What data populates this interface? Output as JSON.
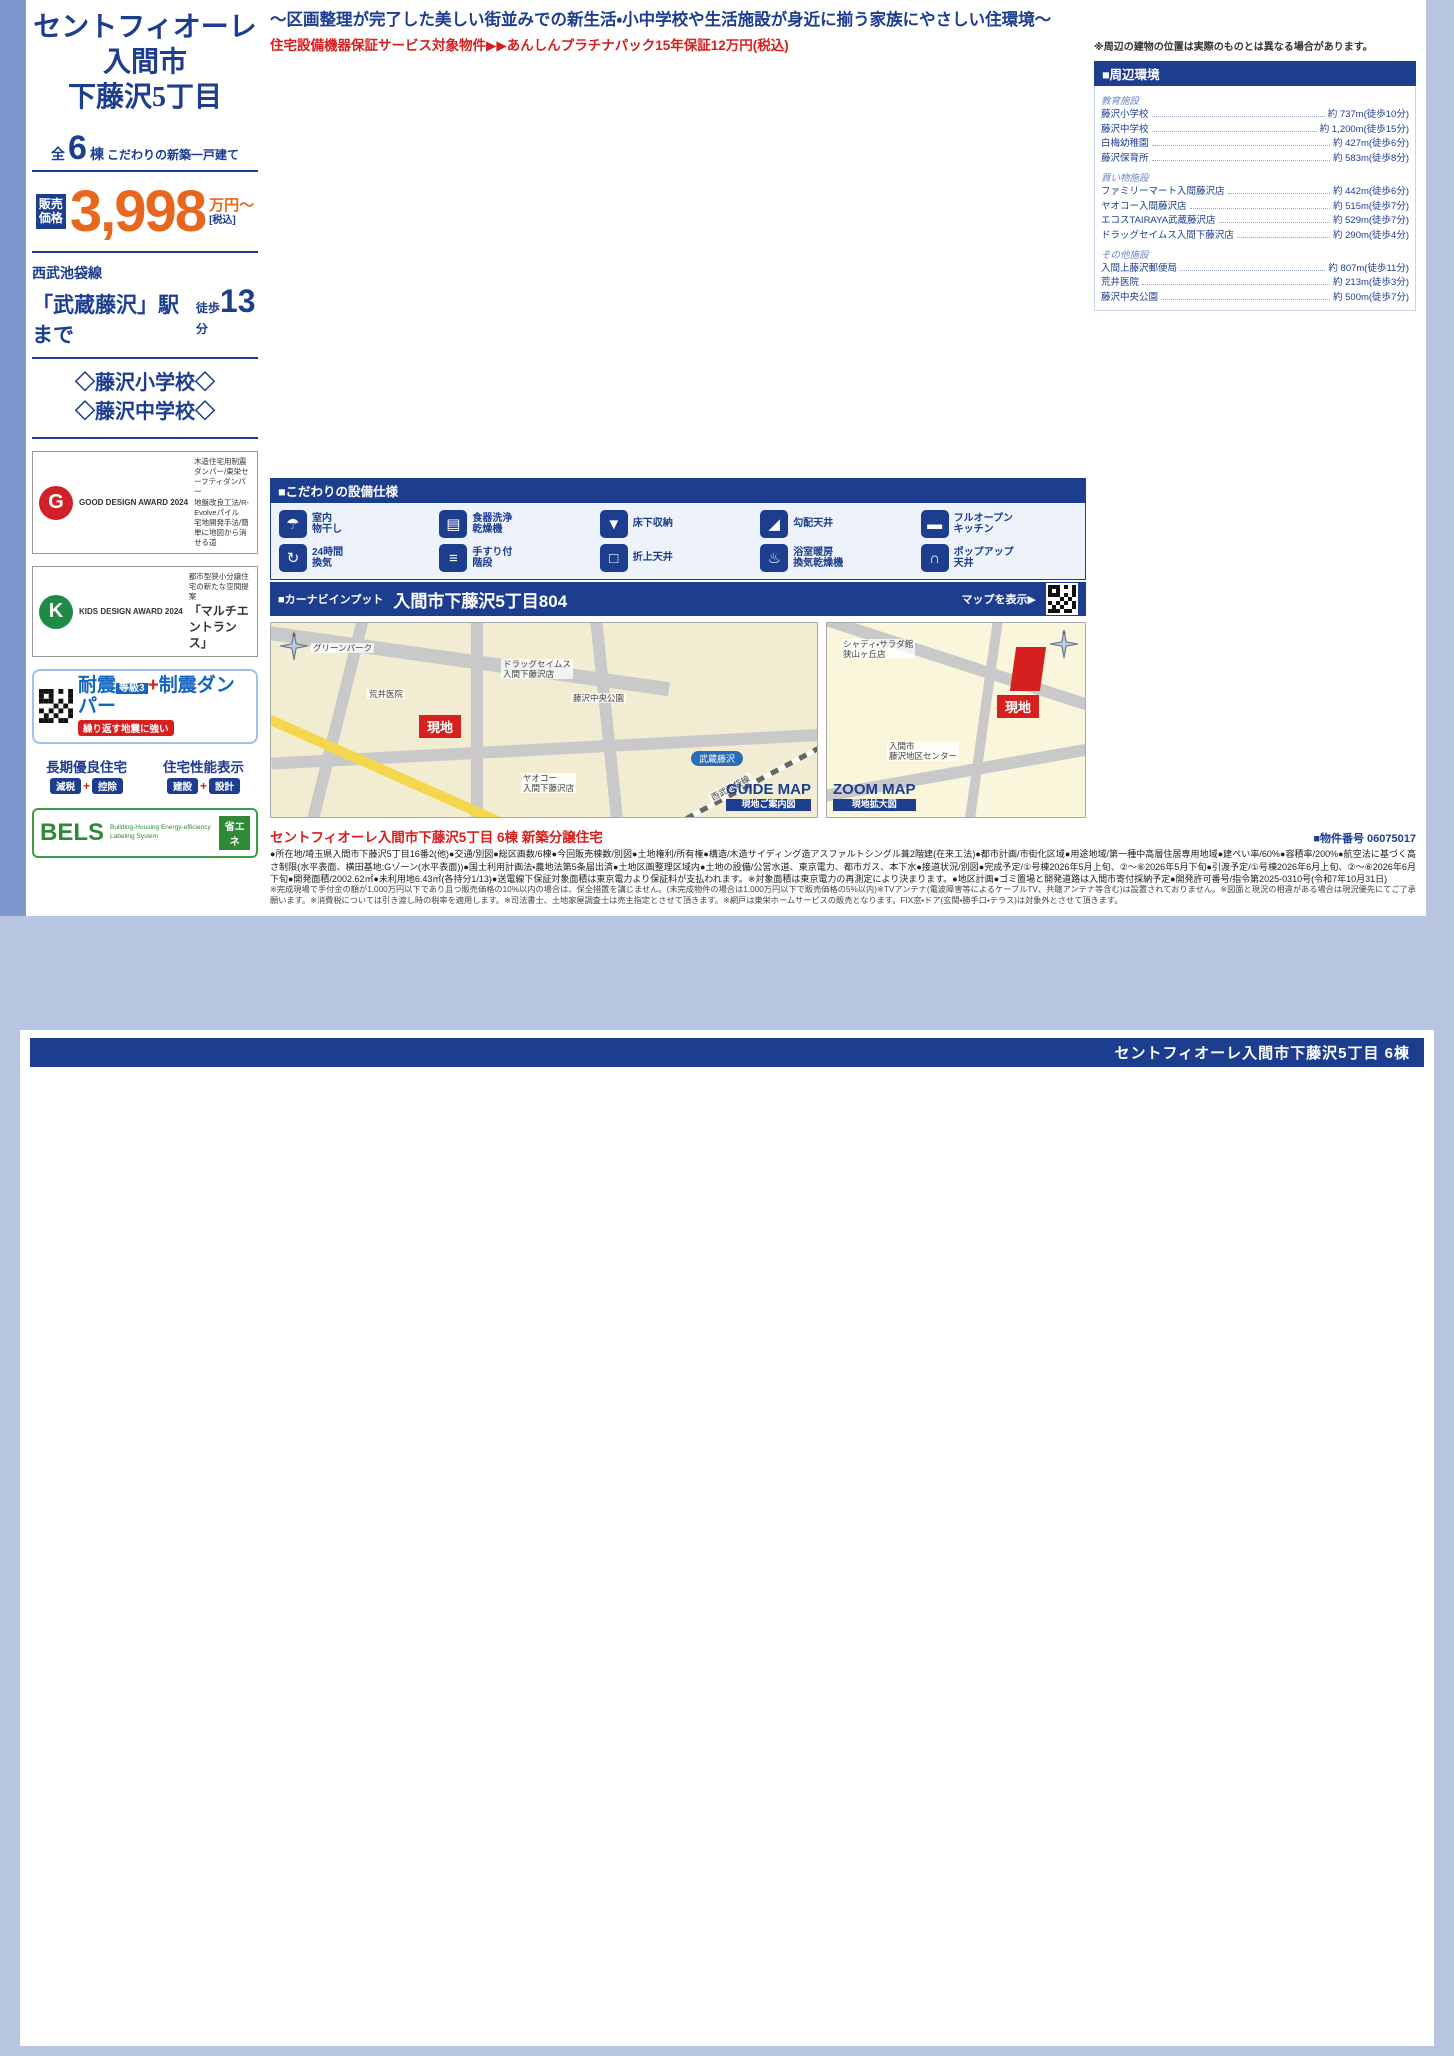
{
  "page1": {
    "catchphrase": "〜区画整理が完了した美しい街並みでの新生活・小中学校や生活施設が身近に揃う家族にやさしい住環境〜",
    "guarantee": "住宅設備機器保証サービス対象物件▶▶あんしんプラチナパック15年保証12万円(税込)",
    "sidebar": {
      "title1": "セントフィオーレ",
      "title2": "入間市",
      "title3": "下藤沢5丁目",
      "count_prefix": "全",
      "count": "6",
      "count_suffix": "棟",
      "count_note": "こだわりの新築一戸建て",
      "price_label": "販売価格",
      "price": "3,998",
      "price_unit": "万円〜",
      "price_tax": "[税込]",
      "rail_line": "西武池袋線",
      "station": "「武蔵藤沢」駅まで",
      "walk_label": "徒歩",
      "walk_min": "13",
      "walk_unit": "分",
      "school1": "◇藤沢小学校◇",
      "school2": "◇藤沢中学校◇",
      "good_design_award": "GOOD DESIGN AWARD 2024",
      "good_design_items": "木造住宅用制震ダンパー/東栄セーフティダンパー\n地盤改良工法/R-Evolveパイル\n宅地開発手法/簡単に地図から消せる道",
      "kids_design_award": "KIDS DESIGN AWARD 2024",
      "kids_design_line1": "都市型狭小分譲住宅の新たな空間提案",
      "kids_design_line2": "「マルチエントランス」",
      "taishin_a": "耐震",
      "taishin_grade": "等級3",
      "taishin_plus": "+",
      "taishin_b": "制震ダンパー",
      "taishin_note": "繰り返す地震に強い",
      "choki_title": "長期優良住宅",
      "choki_tag1": "減税",
      "choki_tag2": "控除",
      "seinou_title": "住宅性能表示",
      "seinou_tag1": "建設",
      "seinou_tag2": "設計",
      "bels_title": "BELS",
      "bels_sub": "Building-Housing Energy-efficiency Labeling System",
      "bels_tag": "省エネ"
    },
    "equipment_title": "■こだわりの設備仕様",
    "equipment": [
      {
        "icon": "☂",
        "name": "indoor-laundry-icon",
        "label": "室内\n物干し"
      },
      {
        "icon": "▤",
        "name": "dishwasher-icon",
        "label": "食器洗浄\n乾燥機"
      },
      {
        "icon": "▼",
        "name": "underfloor-storage-icon",
        "label": "床下収納"
      },
      {
        "icon": "◢",
        "name": "sloped-ceiling-icon",
        "label": "勾配天井"
      },
      {
        "icon": "▬",
        "name": "open-kitchen-icon",
        "label": "フルオープン\nキッチン"
      },
      {
        "icon": "↻",
        "name": "ventilation-icon",
        "label": "24時間\n換気"
      },
      {
        "icon": "≡",
        "name": "handrail-stairs-icon",
        "label": "手すり付\n階段"
      },
      {
        "icon": "□",
        "name": "coffered-ceiling-icon",
        "label": "折上天井"
      },
      {
        "icon": "♨",
        "name": "bath-dryer-icon",
        "label": "浴室暖房\n換気乾燥機"
      },
      {
        "icon": "∩",
        "name": "popup-ceiling-icon",
        "label": "ポップアップ\n天井"
      }
    ],
    "carnav_label": "■カーナビインプット",
    "carnav_address": "入間市下藤沢5丁目804",
    "carnav_map": "マップを表示▶",
    "guide_map": {
      "badge": "GUIDE MAP",
      "badge_sub": "現地ご案内図",
      "site": "現地",
      "station": "武蔵藤沢",
      "line": "西武池袋線",
      "poi1": "ドラッグセイムス\n入間下藤沢店",
      "poi2": "荒井医院",
      "poi3": "藤沢中央公園",
      "poi4": "ヤオコー\n入間下藤沢店",
      "poi5": "グリーンパーク"
    },
    "zoom_map": {
      "badge": "ZOOM MAP",
      "badge_sub": "現地拡大図",
      "site": "現地",
      "poi1": "シャディ・サラダ館\n狭山ヶ丘店",
      "poi2": "入間市\n藤沢地区センター"
    },
    "outline_title": "セントフィオーレ入間市下藤沢5丁目 6棟 新築分譲住宅",
    "outline_number": "■物件番号 06075017",
    "outline_body": "●所在地/埼玉県入間市下藤沢5丁目16番2(他)●交通/別図●総区画数/6棟●今回販売棟数/別図●土地権利/所有権●構造/木造サイディング造アスファルトシングル葺2階建(在来工法)●都市計画/市街化区域●用途地域/第一種中高層住居専用地域●建ぺい率/60%●容積率/200%●航空法に基づく高さ制限(水平表面、横田基地:Gゾーン(水平表面))●国土利用計画法・農地法第5条届出済●土地区画整理区域内●土地の設備/公営水道、東京電力、都市ガス、本下水●接道状況/別図●完成予定/①号棟2026年5月上旬、②〜⑥2026年5月下旬●引渡予定/①号棟2026年6月上旬、②〜⑥2026年6月下旬●開発面積/2002.62㎡●未利用地6.43㎡(各持分1/13)●送電線下保証対象面積は東京電力より保証料が支払われます。※対象面積は東京電力の再測定により決まります。●地区計画●ゴミ置場と開発道路は入間市寄付採納予定●開発許可番号/指令第2025-0310号(令和7年10月31日)",
    "disclaimer": "※完成現場で手付金の額が1,000万円以下であり且つ販売価格の10%以内の場合は、保全措置を講じません。(未完成物件の場合は1,000万円以下で販売価格の5%以内)※TVアンテナ(電波障害等によるケーブルTV、共聴アンテナ等含む)は設置されておりません。※図面と現況の相違がある場合は現況優先にてご了承願います。※消費税については引き渡し時の税率を適用します。※司法書士、土地家屋調査士は売主指定とさせて頂きます。※網戸は東栄ホームサービスの販売となります。FIX窓・ドア(玄関・勝手口・テラス)は対象外とさせて頂きます。"
  },
  "surroundings": {
    "title": "■周辺環境",
    "groups": [
      {
        "name": "教育施設",
        "items": [
          {
            "n": "藤沢小学校",
            "d": "約 737m(徒歩10分)"
          },
          {
            "n": "藤沢中学校",
            "d": "約 1,200m(徒歩15分)"
          },
          {
            "n": "白梅幼稚園",
            "d": "約 427m(徒歩6分)"
          },
          {
            "n": "藤沢保育所",
            "d": "約 583m(徒歩8分)"
          }
        ]
      },
      {
        "name": "買い物施設",
        "items": [
          {
            "n": "ファミリーマート入間藤沢店",
            "d": "約 442m(徒歩6分)"
          },
          {
            "n": "ヤオコー入間藤沢店",
            "d": "約 515m(徒歩7分)"
          },
          {
            "n": "エコスTAIRAYA武蔵藤沢店",
            "d": "約 529m(徒歩7分)"
          },
          {
            "n": "ドラッグセイムス入間下藤沢店",
            "d": "約 290m(徒歩4分)"
          }
        ]
      },
      {
        "name": "その他施設",
        "items": [
          {
            "n": "入間上藤沢郵便局",
            "d": "約 807m(徒歩11分)"
          },
          {
            "n": "荒井医院",
            "d": "約 213m(徒歩3分)"
          },
          {
            "n": "藤沢中央公園",
            "d": "約 500m(徒歩7分)"
          }
        ]
      }
    ]
  },
  "siteplan": {
    "note": "※周辺の建物の位置は実際のものとは異なる場合があります。",
    "road": "開発道路\n446.42m²",
    "road_w": "約4.0m",
    "unused": "未利用地\n6.43m²",
    "parking": "駐車場",
    "park": "公園\n約6.0m",
    "b3": "3階建",
    "soko": "倉庫",
    "plots": [
      "6号棟",
      "1号棟",
      "5号棟",
      "2号棟",
      "4号棟",
      "3号棟"
    ]
  },
  "woodie": {
    "brand": "BLOOMING GARDEN",
    "name": "WOODIE",
    "kana": "ウッディエ",
    "formula": "「WOOD(木調)」+「IE(家)」",
    "desc": "温かみのある木調素材を基調とした外観デザイン"
  },
  "labels": {
    "price_label": "販売\n価格",
    "price_unit": "万円",
    "tax": "[税込]",
    "f1": "1F",
    "f2": "2F"
  },
  "page2_header": "セントフィオーレ入間市下藤沢5丁目 6棟",
  "units": [
    {
      "no": "1号棟",
      "price": "4,380",
      "layout": "3(4)LDK+3WIC+パントリー+カースペース2台",
      "land": "土地面積/118.83㎡ (35.94坪)",
      "building": "建物面積/104.12㎡ (31.48坪)",
      "permit": "建築確認番号/第25UDI1W建11797号",
      "screen": "網戸11万円(税込)で設置可(オプション)",
      "f1": [
        "Entrance",
        "LDK 17.0J",
        "Bath",
        "洗面室",
        "土間収納",
        "シャッター",
        "ポップアップ天井"
      ],
      "f2": [
        "Bedroom 5.87J",
        "Bedroom 6.0J",
        "Bedroom 5.25J",
        "Bedroom 6.0J",
        "WIC",
        "WIC",
        "WIC",
        "CL",
        "Balcony",
        "室内物干",
        "母屋下がり"
      ],
      "callouts": [
        "ベビーカーやスポーツ用品、工具やカー用品が納まる土間収納",
        "将来子供部屋として1部屋を2つの部屋にアレンジできるフレキシブルルーム ※2部屋としてご利用の場合、間仕切壁工事は有償となります。",
        "オシャレなアクセントクロス仕様",
        "浴室乾燥機付のユニットバス",
        "防犯やプライバシーを守りながらの採光に便利",
        "雨の日や、プライバシーが守れる室内物干し",
        "リビング全体が見渡せる対面オープンキッチン(食洗器付き)",
        "天井を高くしてリビングに開放感をプラス",
        "おしゃれな雰囲気を演出するポップアップ天井",
        "2部屋から行き来できる続きバルコニー",
        "衣類はもちろん季節物もたっぷり収納",
        "天井を屋根形状に合わせて高くすることで開放感UP"
      ]
    },
    {
      "no": "2号棟",
      "price": "4,190",
      "layout": "3(4)LDK+カースペース2台",
      "land": "土地面積/118.76㎡ (35.92坪)",
      "building": "建物面積/100.61㎡ (30.42坪)",
      "permit": "建築確認番号/第25UDI1W建12828号",
      "screen": "網戸11万円(税込)で設置可(オプション)",
      "f1": [
        "Entrance",
        "LDK 19.5J",
        "Bath",
        "Washroom",
        "オープンカウンター"
      ],
      "f2": [
        "Bedroom 5.25J",
        "Bedroom 6.0J",
        "Bedroom 5.25J",
        "Bedroom 5.25J",
        "CL",
        "CL",
        "Balcony"
      ],
      "callouts": [
        "日用品などの収納に便利な可動棚付き収納",
        "将来子供部屋として1部屋を2つの部屋にアレンジできるフレキシブルルーム ※2部屋としてご利用の場合、間仕切壁工事は有償となります。",
        "タオルや洗剤などの収納に便利",
        "浴室乾燥機付のユニットバス",
        "2F廊下には掃除機などを片付けられる収納を設置",
        "オシャレなアクセントクロス仕様",
        "おしゃれな雰囲気を演出するポップアップ天井",
        "おしゃれなポップアップ天井で開放感UP",
        "2部屋から行き来できる続きバルコニー",
        "天井を高くしてリビングに開放感をプラス",
        "リビング全体が見渡せる対面オープンキッチン(食洗器付き)",
        "防犯対策のシャッターも標準装備で安心♪"
      ]
    },
    {
      "no": "3号棟",
      "price": "4,290",
      "layout": "4(5)LDK+カースペース2台",
      "land": "土地面積/118.87㎡ (35.95坪)",
      "building": "建物面積/107.85㎡ (32.62坪)",
      "permit": "建築確認番号/第25UDI1W建12829号",
      "screen": "網戸11万円(税込)で設置可(オプション)",
      "f1": [
        "Entrance",
        "LDK 17.0J",
        "Japanese-style room 5.0J",
        "Bath",
        "洗面室"
      ],
      "f2": [
        "Bedroom 5.25J",
        "Bedroom 6.0J",
        "Bedroom 6.12J",
        "Bedroom 5.25J",
        "CL",
        "Inner Balcony"
      ],
      "callouts": [
        "日用品などの収納に便利な可動棚付き収納",
        "将来子供部屋として1部屋を2つの部屋にアレンジできるフレキシブルルーム ※2部屋としてご利用の場合、間仕切壁工事は有償となります。",
        "タオルや洗剤などの収納に便利",
        "浴室乾燥機付のユニットバス",
        "掃除機などを片付けられる収納を設置",
        "オシャレなアクセントクロス仕様",
        "おしゃれな雰囲気を演出するポップアップ天井",
        "リビング全体が見渡せる対面オープンキッチン(食洗器付き)",
        "防犯対策のシャッターも標準装備で安心♪",
        "洋室続きの和室はお子様の遊び場や客間にもおススメです",
        "天井を屋根形状に合わせて高くすることで開放感UP"
      ]
    },
    {
      "no": "4号棟",
      "price": "4,790",
      "layout": "4(5)LDK+2WIC+カースペース2台",
      "land": "土地面積/118.94㎡ (35.97坪)",
      "building": "建物面積/106.71㎡ (32.27坪)",
      "permit": "建築確認番号/第25UDI1W建12830号",
      "screen": "網戸11万円(税込)で設置可(オプション)",
      "f1": [
        "Entrance",
        "LDK 16.5J",
        "Japanese-style room 4.87J",
        "Bath",
        "洗面室"
      ],
      "f2": [
        "Bedroom 5.25J",
        "Bedroom 6.0J",
        "Bedroom 5.25J",
        "Bedroom 5.25J",
        "WIC",
        "WIC",
        "Balcony"
      ],
      "callouts": [
        "リビング全体が見渡せる対面オープンキッチン(食洗器付き)",
        "将来子供部屋として1部屋を2つの部屋にアレンジできるフレキシブルルーム ※2部屋としてご利用の場合、間仕切壁工事は有償となります。",
        "日用品などの収納に便利な可動棚付き収納",
        "2F廊下には掃除機などを片付けられる収納を設置",
        "おしゃれな雰囲気を演出するポップアップ天井",
        "浴室乾燥機付のユニットバス",
        "雨の日や、プライバシーが守れる室内物干し",
        "洋室続きの和室はお子様の遊び場にもおススメです",
        "衣類はもちろん季節物もたっぷり収納",
        "2部屋から行き来できる続きバルコニー",
        "天井を屋根形状に合わせて高くすることで開放感UP",
        "オシャレなアクセントクロス仕様"
      ]
    },
    {
      "no": "5号棟",
      "price": "4,290",
      "layout": "3(4)LDK+WIC+ランドリースペース+カースペース2台",
      "land": "土地面積/118.89㎡ (35.96坪)",
      "building": "建物面積/103.09㎡ (31.18坪)",
      "permit": "建築確認番号/第25UDI1W建12831号",
      "screen": "網戸11万円(税込)で設置可(オプション)",
      "f1": [
        "Entrance",
        "LDK 17.0J",
        "Bath",
        "洗面室",
        "土間収納"
      ],
      "f2": [
        "Bedroom 6.0J",
        "Bedroom 6.0J",
        "Bedroom 5.25J",
        "Bedroom 6.0J",
        "WIC",
        "Balcony"
      ],
      "callouts": [
        "リビング全体が見渡せる対面オープンキッチン(食洗器付き)",
        "オシャレなアクセントクロス仕様",
        "おしゃれな雰囲気を演出するポップアップ天井",
        "日用品などの収納に便利な可動棚付き収納",
        "ベビーカーやスポーツ用品、工具やカー用品が納まる土間収納",
        "防犯対策のシャッターも標準装備で安心♪",
        "2部屋から行き来できる続きバルコニー",
        "雨の日や、プライバシーが守れる室内物干し",
        "タオルなどの収納に便利な可動棚付きの収納",
        "衣類はもちろん季節物もたっぷり収納",
        "天井を高くしてリビングに開放感をプラス",
        "天井を屋根形状に合わせて高くすることで開放感UP"
      ]
    },
    {
      "no": "6号棟",
      "price": "3,998",
      "layout": "3(4)LDK+パントリー+WIC+カースペース2台",
      "land": "土地面積/118.69㎡ (35.90坪)",
      "building": "建物面積/101.88㎡ (30.81坪)",
      "permit": "建築確認番号/第25UDI1W建12832号",
      "screen": "網戸11万円(税込)で設置可(オプション)",
      "f1": [
        "Entrance",
        "LDK 17.0J",
        "Bath",
        "洗面室",
        "パントリー",
        "土間収納"
      ],
      "f2": [
        "Bedroom 5.42J",
        "Bedroom 5.62J",
        "Bedroom 5.25J",
        "Bedroom 6.0J",
        "WIC",
        "Balcony",
        "ポップアップ天井"
      ],
      "callouts": [
        "浴室乾燥機付のユニットバス",
        "タオルや洗剤などの収納に便利",
        "パントリー付きで収納も楽々、キッチンがスッキリ見える",
        "将来子供部屋として1部屋を2つの部屋にアレンジできるフレキシブルルーム ※2部屋としてご利用の場合、間仕切壁工事は有償となります。",
        "衣類はもちろん季節物もたっぷり収納",
        "オシャレなアクセントクロス仕様",
        "おしゃれな雰囲気を演出するポップアップ天井",
        "ベビーカーやスポーツ用品、工具やカー用品が納まる土間収納",
        "雨の日や、プライバシーが守れる室内物干し",
        "リビング全体が見渡せる対面オープンキッチン(食洗器付き)",
        "2部屋から行き来できる続きバルコニー",
        "防犯対策のシャッターも標準装備で安心♪",
        "天井を屋根形状に合わせて高くすることで開放感UP"
      ]
    }
  ]
}
